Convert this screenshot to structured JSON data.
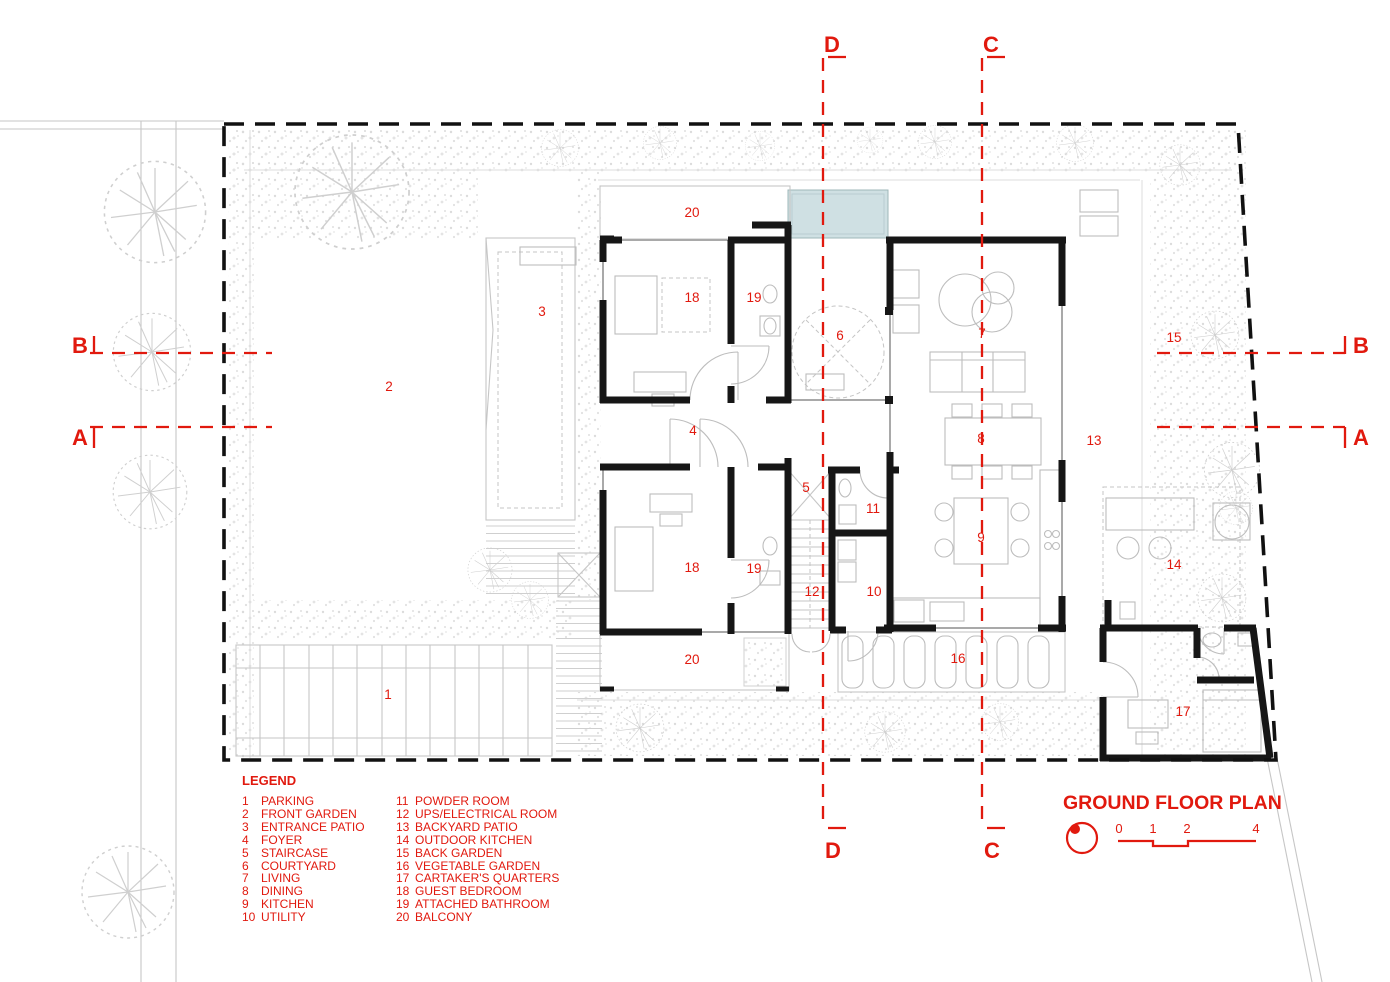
{
  "colors": {
    "accent_red": "#e1190e",
    "wall_black": "#161616",
    "pool_blue": "#cfe0e3"
  },
  "title_block": {
    "title": "GROUND FLOOR PLAN",
    "scale_ticks": [
      "0",
      "1",
      "2",
      "4"
    ]
  },
  "legend": {
    "title": "LEGEND",
    "items": [
      {
        "num": "1",
        "label": "PARKING"
      },
      {
        "num": "2",
        "label": "FRONT GARDEN"
      },
      {
        "num": "3",
        "label": "ENTRANCE PATIO"
      },
      {
        "num": "4",
        "label": "FOYER"
      },
      {
        "num": "5",
        "label": "STAIRCASE"
      },
      {
        "num": "6",
        "label": "COURTYARD"
      },
      {
        "num": "7",
        "label": "LIVING"
      },
      {
        "num": "8",
        "label": "DINING"
      },
      {
        "num": "9",
        "label": "KITCHEN"
      },
      {
        "num": "10",
        "label": "UTILITY"
      },
      {
        "num": "11",
        "label": "POWDER ROOM"
      },
      {
        "num": "12",
        "label": "UPS/ELECTRICAL ROOM"
      },
      {
        "num": "13",
        "label": "BACKYARD PATIO"
      },
      {
        "num": "14",
        "label": "OUTDOOR KITCHEN"
      },
      {
        "num": "15",
        "label": "BACK GARDEN"
      },
      {
        "num": "16",
        "label": "VEGETABLE GARDEN"
      },
      {
        "num": "17",
        "label": "CARTAKER'S QUARTERS"
      },
      {
        "num": "18",
        "label": "GUEST BEDROOM"
      },
      {
        "num": "19",
        "label": "ATTACHED BATHROOM"
      },
      {
        "num": "20",
        "label": "BALCONY"
      }
    ]
  },
  "sections": [
    {
      "id": "section-d-top",
      "label": "D",
      "x": 832,
      "y": 52
    },
    {
      "id": "section-c-top",
      "label": "C",
      "x": 991,
      "y": 52
    },
    {
      "id": "section-d-bottom",
      "label": "D",
      "x": 833,
      "y": 858
    },
    {
      "id": "section-c-bottom",
      "label": "C",
      "x": 992,
      "y": 858
    },
    {
      "id": "section-b-left",
      "label": "B",
      "x": 80,
      "y": 353
    },
    {
      "id": "section-a-left",
      "label": "A",
      "x": 80,
      "y": 445
    },
    {
      "id": "section-b-right",
      "label": "B",
      "x": 1361,
      "y": 353
    },
    {
      "id": "section-a-right",
      "label": "A",
      "x": 1361,
      "y": 445
    }
  ],
  "room_labels": [
    {
      "num": "20",
      "x": 692,
      "y": 217
    },
    {
      "num": "18",
      "x": 692,
      "y": 302
    },
    {
      "num": "19",
      "x": 754,
      "y": 302
    },
    {
      "num": "3",
      "x": 542,
      "y": 316
    },
    {
      "num": "6",
      "x": 840,
      "y": 340
    },
    {
      "num": "7",
      "x": 982,
      "y": 338
    },
    {
      "num": "15",
      "x": 1174,
      "y": 342
    },
    {
      "num": "2",
      "x": 389,
      "y": 391
    },
    {
      "num": "4",
      "x": 693,
      "y": 435
    },
    {
      "num": "8",
      "x": 981,
      "y": 443
    },
    {
      "num": "13",
      "x": 1094,
      "y": 445
    },
    {
      "num": "5",
      "x": 806,
      "y": 492
    },
    {
      "num": "11",
      "x": 873,
      "y": 513
    },
    {
      "num": "9",
      "x": 981,
      "y": 542
    },
    {
      "num": "14",
      "x": 1174,
      "y": 569
    },
    {
      "num": "18",
      "x": 692,
      "y": 572
    },
    {
      "num": "19",
      "x": 754,
      "y": 573
    },
    {
      "num": "12",
      "x": 812,
      "y": 596
    },
    {
      "num": "10",
      "x": 874,
      "y": 596
    },
    {
      "num": "16",
      "x": 958,
      "y": 663
    },
    {
      "num": "20",
      "x": 692,
      "y": 664
    },
    {
      "num": "1",
      "x": 388,
      "y": 699
    },
    {
      "num": "17",
      "x": 1183,
      "y": 716
    }
  ]
}
